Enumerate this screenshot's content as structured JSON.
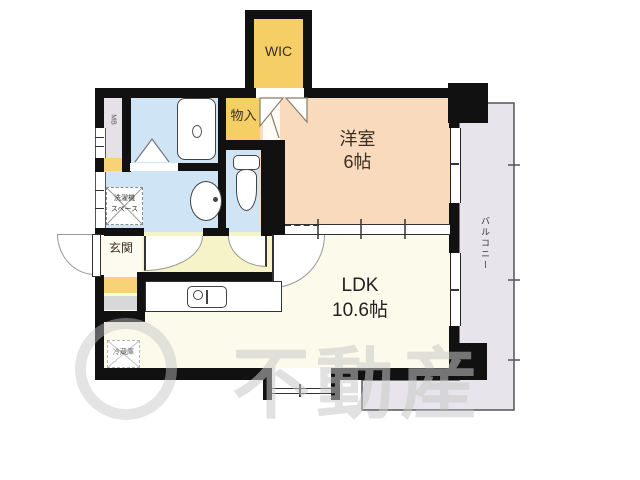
{
  "plan": {
    "rooms": {
      "wic": {
        "label": "WIC"
      },
      "monoire": {
        "label": "物入"
      },
      "yoshitsu": {
        "name": "洋室",
        "size": "6帖"
      },
      "ldk": {
        "name": "LDK",
        "size": "10.6帖"
      },
      "genkan": {
        "label": "玄関"
      },
      "balcony": {
        "label": "バルコニー"
      },
      "mb": {
        "label": "MB"
      }
    },
    "fixtures": {
      "washer_space": {
        "line1": "洗濯機",
        "line2": "スペース"
      },
      "fridge": {
        "label": "冷蔵庫"
      }
    },
    "watermark": {
      "text": "不動産"
    },
    "colors": {
      "wall": "#111111",
      "western_room": "#f9dabc",
      "ldk": "#fcfaeb",
      "corridor": "#f7f3c8",
      "wet_area": "#cfe4f4",
      "closet": "#f5cf66",
      "balcony": "#e7e4ec",
      "accent_yellow": "#f7d277",
      "cabinet_gray": "#d8d8d8"
    }
  }
}
